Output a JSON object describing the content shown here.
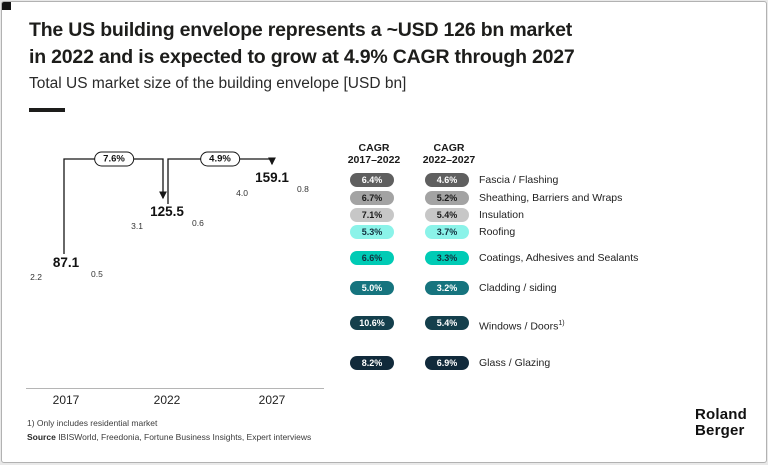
{
  "slide": {
    "title_line1": "The US building envelope represents a ~USD 126 bn market",
    "title_line2": "in 2022 and is expected to grow at 4.9% CAGR through 2027",
    "subtitle": "Total US market size of the building envelope [USD bn]"
  },
  "palette": {
    "fascia": {
      "bg": "#5f5f5f",
      "text": "#ffffff"
    },
    "sheathing": {
      "bg": "#a3a3a3",
      "text": "#1a1a1a"
    },
    "insulation": {
      "bg": "#c7c7c7",
      "text": "#1a1a1a"
    },
    "roofing": {
      "bg": "#8bf3e9",
      "text": "#13303f"
    },
    "coatings": {
      "bg": "#00cbb5",
      "text": "#13303f"
    },
    "cladding": {
      "bg": "#16747e",
      "text": "#ffffff"
    },
    "windows": {
      "bg": "#143f4c",
      "text": "#ffffff"
    },
    "glass": {
      "bg": "#112a3b",
      "text": "#ffffff"
    }
  },
  "chart_data": {
    "type": "bar",
    "stacked": true,
    "title": "Total US market size of the building envelope [USD bn]",
    "unit": "USD bn",
    "categories": [
      "2017",
      "2022",
      "2027"
    ],
    "totals": [
      "87.1",
      "125.5",
      "159.1"
    ],
    "growth": [
      {
        "label": "7.6%",
        "from": "2017",
        "to": "2022"
      },
      {
        "label": "4.9%",
        "from": "2022",
        "to": "2027"
      }
    ],
    "series": [
      {
        "key": "glass",
        "name": "Glass / Glazing",
        "values": [
          "18.7",
          "28.8",
          "40.1"
        ],
        "label_pos": "inside"
      },
      {
        "key": "windows",
        "name": "Windows / Doors",
        "values": [
          "14.8",
          "24.5",
          "31.9"
        ],
        "label_pos": "inside"
      },
      {
        "key": "cladding",
        "name": "Cladding / siding",
        "values": [
          "17.7",
          "22.9",
          "26.8"
        ],
        "label_pos": "inside"
      },
      {
        "key": "coatings",
        "name": "Coatings, Adhesives and Sealants",
        "values": [
          "13.0",
          "22.9",
          "21.6"
        ],
        "label_pos": "inside"
      },
      {
        "key": "roofing",
        "name": "Roofing",
        "values": [
          "13.3",
          "17.5",
          "21.0"
        ],
        "label_pos": "inside"
      },
      {
        "key": "insulation",
        "name": "Insulation",
        "values": [
          "6.8",
          "9.8",
          "12.8"
        ],
        "label_pos": "inside"
      },
      {
        "key": "sheathing",
        "name": "Sheathing, Barriers and Wraps",
        "values": [
          "2.2",
          "3.1",
          "4.0"
        ],
        "label_pos": "left"
      },
      {
        "key": "fascia",
        "name": "Fascia / Flashing",
        "values": [
          "0.5",
          "0.6",
          "0.8"
        ],
        "label_pos": "right"
      }
    ]
  },
  "cagr_table": {
    "col1_line1": "CAGR",
    "col1_line2": "2017–2022",
    "col2_line1": "CAGR",
    "col2_line2": "2022–2027",
    "rows": [
      {
        "key": "fascia",
        "label": "Fascia / Flashing",
        "sup": "",
        "cagr1": "6.4%",
        "cagr2": "4.6%"
      },
      {
        "key": "sheathing",
        "label": "Sheathing, Barriers and Wraps",
        "sup": "",
        "cagr1": "6.7%",
        "cagr2": "5.2%"
      },
      {
        "key": "insulation",
        "label": "Insulation",
        "sup": "",
        "cagr1": "7.1%",
        "cagr2": "5.4%"
      },
      {
        "key": "roofing",
        "label": "Roofing",
        "sup": "",
        "cagr1": "5.3%",
        "cagr2": "3.7%"
      },
      {
        "key": "coatings",
        "label": "Coatings, Adhesives and Sealants",
        "sup": "",
        "cagr1": "6.6%",
        "cagr2": "3.3%"
      },
      {
        "key": "cladding",
        "label": "Cladding / siding",
        "sup": "",
        "cagr1": "5.0%",
        "cagr2": "3.2%"
      },
      {
        "key": "windows",
        "label": "Windows / Doors",
        "sup": "1)",
        "cagr1": "10.6%",
        "cagr2": "5.4%"
      },
      {
        "key": "glass",
        "label": "Glass / Glazing",
        "sup": "",
        "cagr1": "8.2%",
        "cagr2": "6.9%"
      }
    ]
  },
  "footer": {
    "footnote": "1) Only includes residential market",
    "source_label": "Source",
    "source_text": " IBISWorld, Freedonia, Fortune Business Insights, Expert interviews"
  },
  "logo": {
    "line1": "Roland",
    "line2": "Berger"
  }
}
